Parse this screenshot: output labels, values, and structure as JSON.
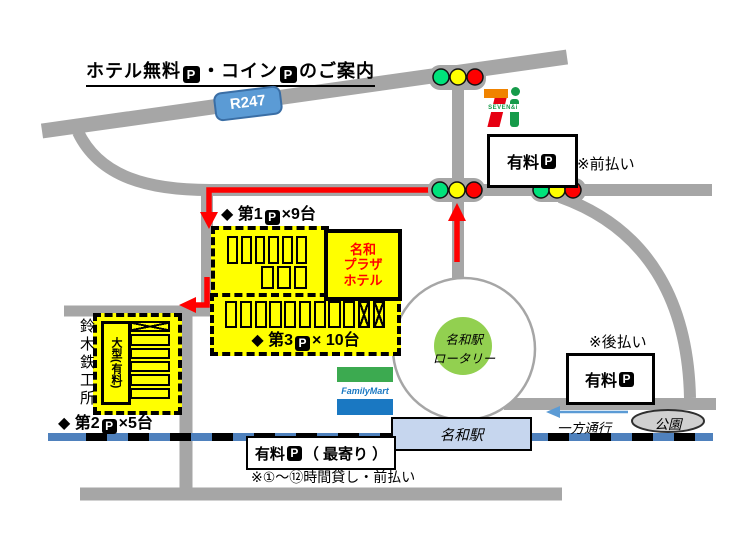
{
  "title": {
    "part1": "ホテル無料",
    "part2": "・コイン",
    "part3": "のご案内",
    "p_icon": "P"
  },
  "road_sign": {
    "label": "R247"
  },
  "seven_eleven": {
    "brand": "SEVEN&i"
  },
  "parking_top": {
    "label": "有料",
    "note": "※前払い"
  },
  "lot1": {
    "label_prefix": "◆ 第1",
    "label_suffix": "×9台"
  },
  "hotel": {
    "name": "名和\nプラザ\nホテル"
  },
  "lot3": {
    "label_prefix": "◆ 第3",
    "label_suffix": "× 10台"
  },
  "suzuki": {
    "name": "鈴木鉄工所"
  },
  "lot2": {
    "inner_label": "大型(有料)",
    "label_prefix": "◆ 第2",
    "label_suffix": "×5台"
  },
  "rotary": {
    "label": "名和駅\nロータリー"
  },
  "familymart": {
    "brand": "FamilyMart"
  },
  "parking_right": {
    "note": "※後払い",
    "label": "有料"
  },
  "oneway": {
    "label": "一方通行"
  },
  "park": {
    "label": "公園"
  },
  "station": {
    "label": "名和駅"
  },
  "parking_near": {
    "label_prefix": "有料",
    "label_suffix": "（ 最寄り ）"
  },
  "bottom_note": "※①～⑫時間貸し・前払い",
  "stalls": {
    "lot1_top": {
      "count": 6,
      "crossed": []
    },
    "lot1_bottom": {
      "count": 3,
      "crossed": []
    },
    "lot3_row": {
      "count": 11,
      "crossed": [
        9,
        10
      ]
    },
    "lot2_col": {
      "count": 6,
      "crossed": [
        0
      ]
    }
  },
  "colors": {
    "road": "#a6a6a6",
    "route_arrow": "#ff0000",
    "lot_yellow": "#ffff00",
    "railway_blue": "#4f81bd",
    "station_fill": "#c6d6ee",
    "rotary_green": "#92d050",
    "sign_blue": "#5b9bd5",
    "signal_green": "#00e27b",
    "signal_yellow": "#ffff00",
    "signal_red": "#fe0000"
  }
}
